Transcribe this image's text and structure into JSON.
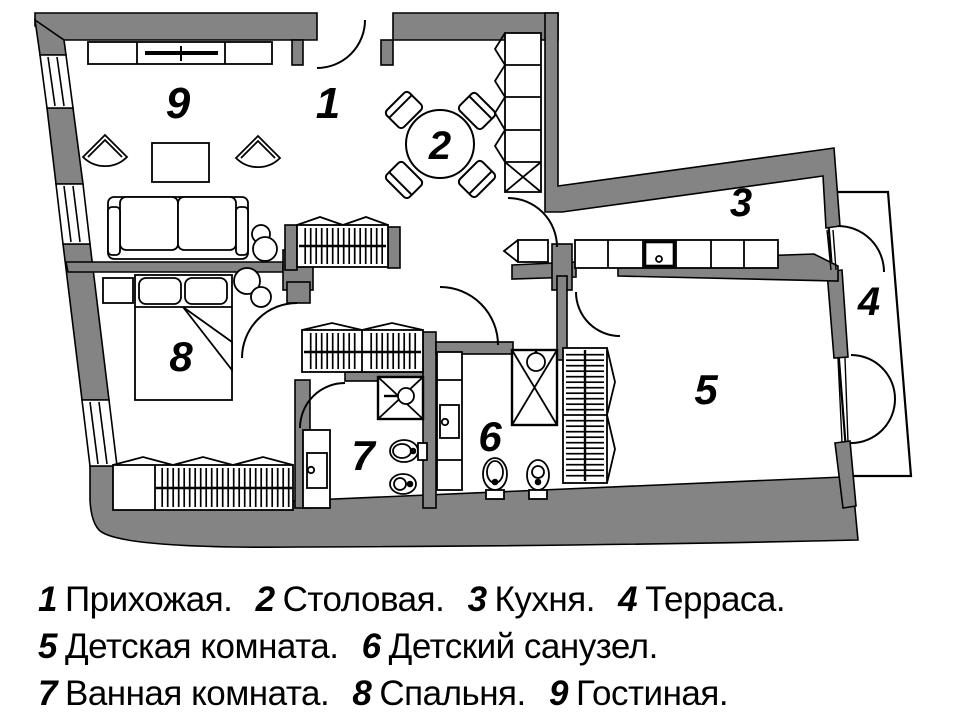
{
  "title": "Apartment floor plan",
  "colors": {
    "wall": "#848484",
    "line": "#000000",
    "background": "#ffffff"
  },
  "rooms": [
    {
      "number": "1",
      "name": "Прихожая"
    },
    {
      "number": "2",
      "name": "Столовая"
    },
    {
      "number": "3",
      "name": "Кухня"
    },
    {
      "number": "4",
      "name": "Терраса"
    },
    {
      "number": "5",
      "name": "Детская комната"
    },
    {
      "number": "6",
      "name": "Детский санузел"
    },
    {
      "number": "7",
      "name": "Ванная комната"
    },
    {
      "number": "8",
      "name": "Спальня"
    },
    {
      "number": "9",
      "name": "Гостиная"
    }
  ],
  "legend": {
    "items": [
      {
        "num": "1",
        "label": "Прихожая."
      },
      {
        "num": "2",
        "label": "Столовая."
      },
      {
        "num": "3",
        "label": "Кухня."
      },
      {
        "num": "4",
        "label": "Терраса."
      },
      {
        "num": "5",
        "label": "Детская комната."
      },
      {
        "num": "6",
        "label": "Детский санузел."
      },
      {
        "num": "7",
        "label": "Ванная комната."
      },
      {
        "num": "8",
        "label": "Спальня."
      },
      {
        "num": "9",
        "label": "Гостиная."
      }
    ]
  }
}
